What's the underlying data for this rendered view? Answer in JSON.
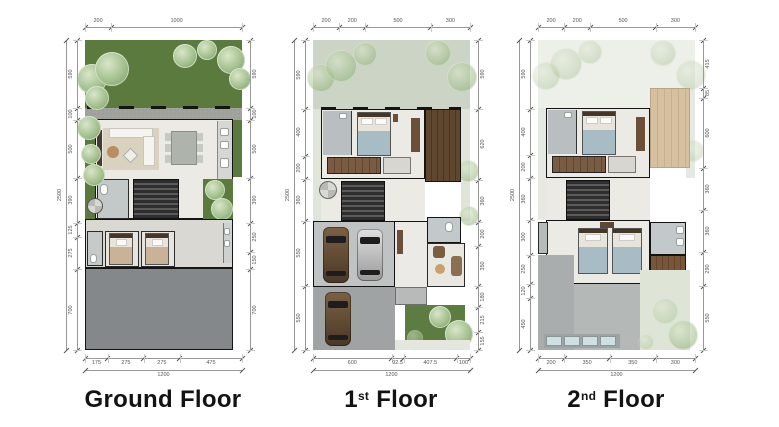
{
  "colors": {
    "lawn": "#5b7a3e",
    "lawn_pale": "#ccd5c5",
    "lawn_ghost": "#edefe9",
    "tile": "#eceae5",
    "gravel": "#a2a39e",
    "driveway": "#85888a",
    "garage": "#c0c3c4",
    "driveway_upper": "#9fa3a4",
    "wood": "#5e462f",
    "wood_light": "#7a5638",
    "tan_roof": "#d5c0a0",
    "roof_gray": "#a9adad",
    "skylight": "#cfe0e3",
    "bed_tan": "#c9b295",
    "bed_blue": "#a8bcc6",
    "wall": "#141414",
    "dim": "#555555",
    "title": "#131313"
  },
  "floors": [
    {
      "id": "ground-floor",
      "title": {
        "prefix": "Ground",
        "sup": "",
        "suffix": " Floor"
      },
      "dims": {
        "top": [
          "200",
          "1000"
        ],
        "bottom": [
          "175",
          "275",
          "275",
          "475"
        ],
        "bottom_total": "1200",
        "left": [
          "590",
          "100",
          "500",
          "390",
          "125",
          "275",
          "700"
        ],
        "left_total": "2500",
        "right": [
          "590",
          "100",
          "500",
          "390",
          "250",
          "150",
          "700"
        ]
      }
    },
    {
      "id": "first-floor",
      "title": {
        "prefix": "1",
        "sup": "st",
        "suffix": " Floor"
      },
      "dims": {
        "top": [
          "200",
          "200",
          "500",
          "300"
        ],
        "bottom": [
          "600",
          "92.5",
          "407.5",
          "100"
        ],
        "bottom_total": "1200",
        "left": [
          "590",
          "400",
          "200",
          "360",
          "550",
          "550"
        ],
        "left_total": "2500",
        "right": [
          "590",
          "620",
          "360",
          "200",
          "350",
          "180",
          "215",
          "155"
        ]
      }
    },
    {
      "id": "second-floor",
      "title": {
        "prefix": "2",
        "sup": "nd",
        "suffix": " Floor"
      },
      "dims": {
        "top": [
          "200",
          "200",
          "500",
          "300"
        ],
        "bottom": [
          "200",
          "350",
          "350",
          "300"
        ],
        "bottom_total": "1200",
        "left": [
          "590",
          "400",
          "200",
          "360",
          "300",
          "250",
          "120",
          "450"
        ],
        "left_total": "2500",
        "right": [
          "415",
          "85",
          "600",
          "360",
          "360",
          "290",
          "550"
        ]
      }
    }
  ]
}
